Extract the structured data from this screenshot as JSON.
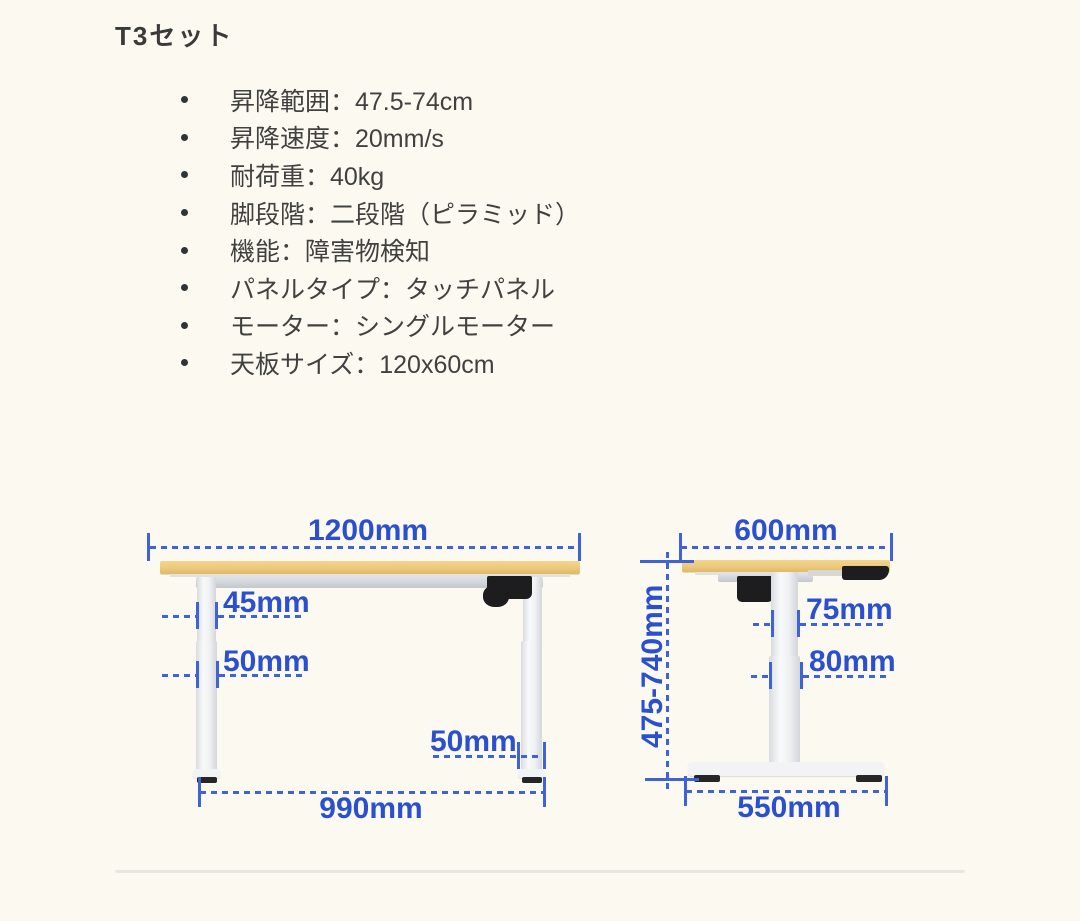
{
  "title": "T3セット",
  "specs": [
    "昇降範囲：47.5-74cm",
    "昇降速度：20mm/s",
    "耐荷重：40kg",
    "脚段階：二段階（ピラミッド）",
    "機能：障害物検知",
    "パネルタイプ：タッチパネル",
    "モーター：シングルモーター",
    "天板サイズ：120x60cm"
  ],
  "front_view": {
    "top_width": "1200mm",
    "upper_leg_width": "45mm",
    "lower_leg_width": "50mm",
    "foot_column_width": "50mm",
    "base_span": "990mm"
  },
  "side_view": {
    "top_depth": "600mm",
    "height_range": "475-740mm",
    "upper_column_depth": "75mm",
    "lower_column_depth": "80mm",
    "foot_depth": "550mm"
  },
  "colors": {
    "dimension_text_blue": "#2B50CF",
    "dimension_line_blue": "#3E62D9",
    "tabletop_wood": "#EBC77A",
    "background_cream": "#FCFAF0"
  }
}
